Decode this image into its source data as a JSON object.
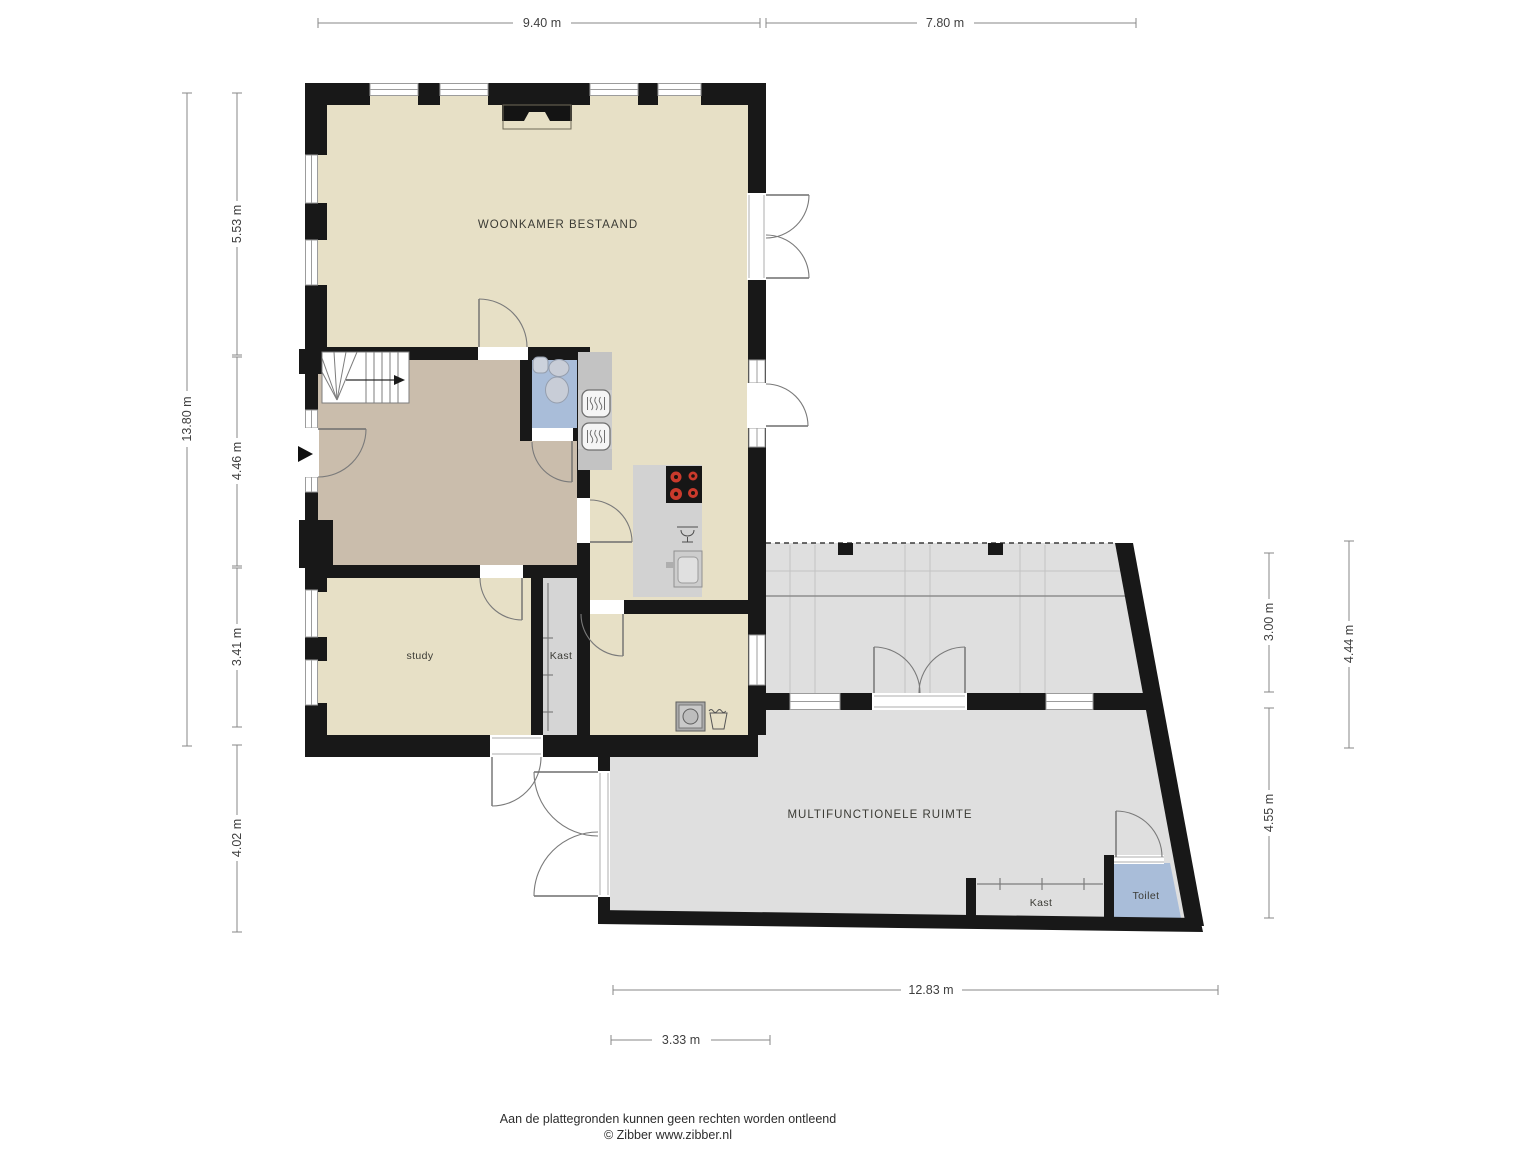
{
  "plan": {
    "rooms": {
      "woonkamer": "WOONKAMER BESTAAND",
      "study": "study",
      "kast_study": "Kast",
      "multifunctionele_ruimte": "MULTIFUNCTIONELE RUIMTE",
      "kast_multi": "Kast",
      "toilet_multi": "Toilet"
    },
    "dimensions": {
      "top_left": "9.40 m",
      "top_right": "7.80 m",
      "left_total": "13.80 m",
      "left_1": "5.53 m",
      "left_2": "4.46 m",
      "left_3": "3.41 m",
      "left_4": "4.02 m",
      "right_1": "3.00 m",
      "right_2": "4.55 m",
      "right_3": "4.44 m",
      "bottom_1": "12.83 m",
      "bottom_2": "3.33 m"
    },
    "colors": {
      "wall": "#181818",
      "floor_main": "#e7e0c6",
      "floor_hall": "#cabdac",
      "floor_gray": "#dfdfdf",
      "toilet_blue": "#a9bdd9",
      "burner_red": "#ca3a2c"
    },
    "footer": {
      "disclaimer": "Aan de plattegronden kunnen geen rechten worden ontleend",
      "credit": "© Zibber www.zibber.nl"
    }
  }
}
